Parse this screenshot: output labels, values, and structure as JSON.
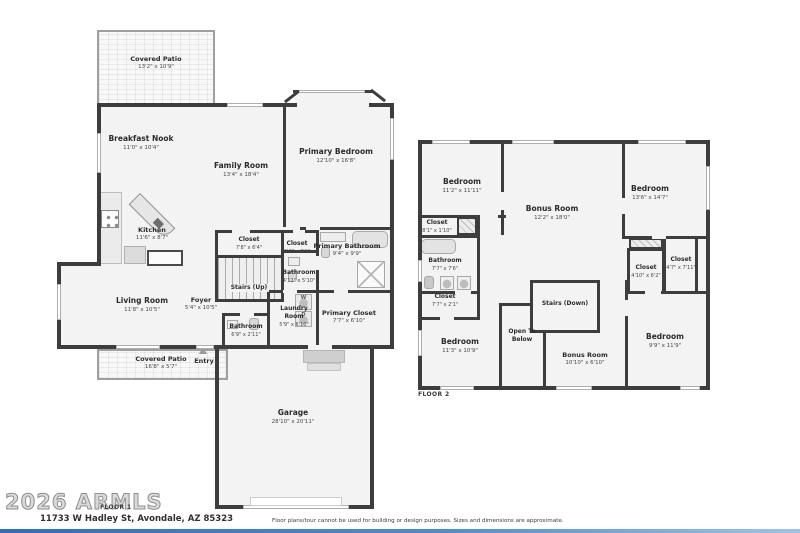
{
  "meta": {
    "branding": "2026 ARMLS",
    "floor1_tag": "FLOOR 1",
    "floor2_tag": "FLOOR 2",
    "address": "11733 W Hadley St, Avondale, AZ 85323",
    "disclaimer": "Floor plans/tour cannot be used for building or design purposes. Sizes and dimensions are approximate.",
    "colors": {
      "wall": "#3d3d3d",
      "room_fill": "#f3f3f3",
      "accent_bar": "#2f6fba"
    }
  },
  "floor1": {
    "fixtures": {
      "washer": "W",
      "dryer": "D"
    },
    "rooms": {
      "covered_patio_top": {
        "name": "Covered Patio",
        "dims": "13'2\" x 10'9\""
      },
      "breakfast_nook": {
        "name": "Breakfast Nook",
        "dims": "11'0\" x 10'4\""
      },
      "family_room": {
        "name": "Family Room",
        "dims": "13'4\" x 18'4\""
      },
      "primary_bedroom": {
        "name": "Primary Bedroom",
        "dims": "12'10\" x 16'8\""
      },
      "kitchen": {
        "name": "Kitchen",
        "dims": "11'6\" x 8'7\""
      },
      "closet_hall": {
        "name": "Closet",
        "dims": "7'8\" x 6'4\""
      },
      "closet_small": {
        "name": "Closet",
        "dims": "3'2\" x 2'1\""
      },
      "primary_bathroom": {
        "name": "Primary Bathroom",
        "dims": "9'4\" x 9'9\""
      },
      "bathroom_mid": {
        "name": "Bathroom",
        "dims": "4'11\" x 5'10\""
      },
      "stairs_up": {
        "name": "Stairs (Up)"
      },
      "living_room": {
        "name": "Living Room",
        "dims": "11'8\" x 10'5\""
      },
      "foyer": {
        "name": "Foyer",
        "dims": "5'4\" x 10'5\""
      },
      "laundry_room": {
        "name": "Laundry Room",
        "dims": "5'9\" x 6'10\""
      },
      "primary_closet": {
        "name": "Primary Closet",
        "dims": "7'7\" x 6'10\""
      },
      "bathroom_small": {
        "name": "Bathroom",
        "dims": "6'9\" x 2'11\""
      },
      "covered_patio_bottom": {
        "name": "Covered Patio",
        "dims": "16'8\" x 5'7\""
      },
      "entry": {
        "name": "Entry"
      },
      "garage": {
        "name": "Garage",
        "dims": "28'10\" x 20'11\""
      }
    }
  },
  "floor2": {
    "rooms": {
      "bedroom_tl": {
        "name": "Bedroom",
        "dims": "11'2\" x 11'11\""
      },
      "bonus_room": {
        "name": "Bonus Room",
        "dims": "12'2\" x 18'0\""
      },
      "bedroom_tr": {
        "name": "Bedroom",
        "dims": "13'6\" x 14'7\""
      },
      "closet_left": {
        "name": "Closet",
        "dims": "8'1\" x 1'10\""
      },
      "bathroom": {
        "name": "Bathroom",
        "dims": "7'7\" x 7'6\""
      },
      "closet_left2": {
        "name": "Closet",
        "dims": "7'7\" x 2'1\""
      },
      "stairs_down": {
        "name": "Stairs (Down)"
      },
      "open_to_below": {
        "name": "Open To Below"
      },
      "bedroom_bl": {
        "name": "Bedroom",
        "dims": "11'3\" x 10'9\""
      },
      "bonus_room_b": {
        "name": "Bonus Room",
        "dims": "10'10\" x 6'10\""
      },
      "bedroom_br": {
        "name": "Bedroom",
        "dims": "9'9\" x 11'9\""
      },
      "closet_r1": {
        "name": "Closet",
        "dims": "4'10\" x 6'2\""
      },
      "closet_r2": {
        "name": "Closet",
        "dims": "4'7\" x 7'11\""
      }
    }
  }
}
